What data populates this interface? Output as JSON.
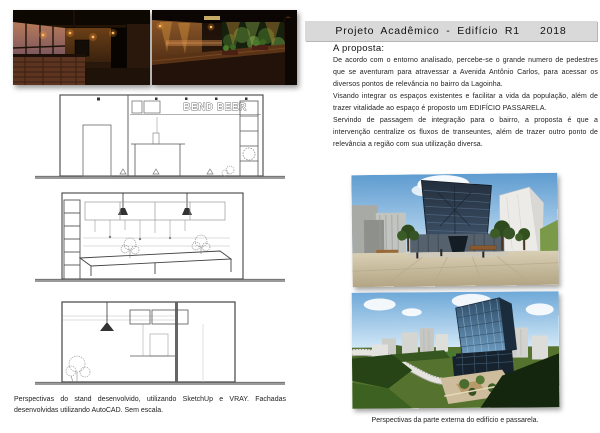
{
  "header": {
    "title": "Projeto Acadêmico - Edifício R1   2018"
  },
  "proposta": {
    "heading": "A proposta:",
    "paragraphs": {
      "p1": "De acordo com o entorno analisado, percebe-se o grande numero de pedestres que se aventuram para atravessar a Avenida Antônio Carlos, para acessar os diversos pontos de relevância no bairro da Lagoinha.",
      "p2": "Visando integrar os espaços existentes e facilitar a vida da população, além de trazer vitalidade ao espaço é proposto um EDIFÍCIO PASSARELA.",
      "p3": "Servindo de passagem de integração para o bairro, a proposta é que a intervenção centralize os fluxos de transeuntes, além de trazer outro ponto de relevância a região com sua utilização diversa."
    }
  },
  "drawings": {
    "sign_text": "BEND BEER"
  },
  "captions": {
    "stand": "Perspectivas do stand desenvolvido, utilizando SketchUp e VRAY. Fachadas desenvolvidas utilizando AutoCAD. Sem escala.",
    "edificio": "Perspectivas da parte externa do edifício e passarela."
  },
  "colors": {
    "title_bar": "#d9d9d9",
    "page": "#ffffff",
    "text": "#1c1c1c"
  }
}
